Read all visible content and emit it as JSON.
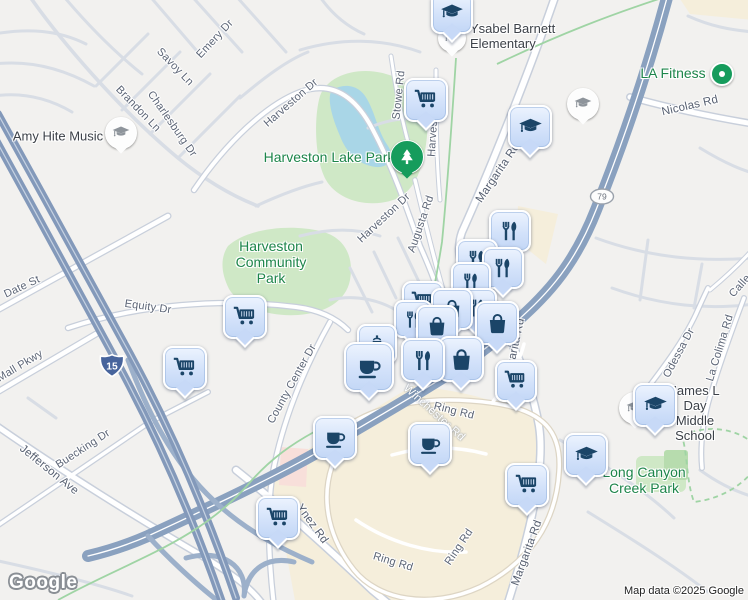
{
  "map": {
    "logo": "Google",
    "attribution": "Map data ©2025 Google",
    "colors": {
      "marker_fill": "#cfdffa",
      "marker_icon": "#1b4568",
      "gray_marker_icon": "#8e949b",
      "poi_green": "#1d854a",
      "street_label": "#5c6576",
      "freeway": "#8399ba",
      "park": "#cfe8c6",
      "water": "#a9d6e7",
      "commercial": "#f5eedb",
      "shield_interstate": "#47649c"
    },
    "shields": [
      {
        "id": "i-15",
        "system": "interstate",
        "label": "15",
        "x": 112,
        "y": 368
      },
      {
        "id": "ca-79",
        "system": "state",
        "label": "79",
        "x": 602,
        "y": 199
      }
    ],
    "street_labels": [
      {
        "id": "savoy-ln",
        "text": "Savoy Ln",
        "x": 175,
        "y": 67,
        "rot": 46
      },
      {
        "id": "emery-dr",
        "text": "Emery Dr",
        "x": 215,
        "y": 39,
        "rot": -47
      },
      {
        "id": "brandon-ln",
        "text": "Brandon Ln",
        "x": 138,
        "y": 109,
        "rot": 46
      },
      {
        "id": "charlesburg-dr",
        "text": "Charlesburg Dr",
        "x": 172,
        "y": 124,
        "rot": 55
      },
      {
        "id": "harveston-dr-1",
        "text": "Harveston Dr",
        "x": 291,
        "y": 103,
        "rot": -41
      },
      {
        "id": "stowe-rd",
        "text": "Stowe Rd",
        "x": 399,
        "y": 95,
        "rot": -84
      },
      {
        "id": "harveston-rd",
        "text": "Harveston Rd",
        "x": 434,
        "y": 122,
        "rot": -86
      },
      {
        "id": "nicolas-rd",
        "text": "Nicolas Rd",
        "x": 690,
        "y": 106,
        "rot": -13,
        "variant": "major"
      },
      {
        "id": "margarita-rd-1",
        "text": "Margarita Rd",
        "x": 498,
        "y": 173,
        "rot": -56,
        "variant": "major"
      },
      {
        "id": "harveston-dr-2",
        "text": "Harveston Dr",
        "x": 384,
        "y": 218,
        "rot": -43
      },
      {
        "id": "augusta-rd",
        "text": "Augusta Rd",
        "x": 421,
        "y": 224,
        "rot": -71
      },
      {
        "id": "date-st",
        "text": "Date St",
        "x": 22,
        "y": 287,
        "rot": -25
      },
      {
        "id": "equity-dr",
        "text": "Equity Dr",
        "x": 148,
        "y": 307,
        "rot": 8
      },
      {
        "id": "mall-pkwy",
        "text": "Mall Pkwy",
        "x": 20,
        "y": 366,
        "rot": -31
      },
      {
        "id": "county-center-dr",
        "text": "County Center Dr",
        "x": 292,
        "y": 384,
        "rot": -61
      },
      {
        "id": "winchester-rd",
        "text": "Winchester Rd",
        "x": 434,
        "y": 413,
        "rot": 42,
        "variant": "onroad major"
      },
      {
        "id": "ynez-rd",
        "text": "Ynez Rd",
        "x": 312,
        "y": 524,
        "rot": 54,
        "variant": "major"
      },
      {
        "id": "ring-rd-1",
        "text": "Ring Rd",
        "x": 454,
        "y": 411,
        "rot": 14
      },
      {
        "id": "ring-rd-2",
        "text": "Ring Rd",
        "x": 459,
        "y": 547,
        "rot": -56
      },
      {
        "id": "ring-rd-3",
        "text": "Ring Rd",
        "x": 393,
        "y": 562,
        "rot": 17
      },
      {
        "id": "jefferson-ave",
        "text": "Jefferson Ave",
        "x": 49,
        "y": 470,
        "rot": 39,
        "variant": "major"
      },
      {
        "id": "buecking-dr",
        "text": "Buecking Dr",
        "x": 83,
        "y": 449,
        "rot": -33
      },
      {
        "id": "margarita-rd-2",
        "text": "Margarita Rd",
        "x": 527,
        "y": 553,
        "rot": -70,
        "variant": "major"
      },
      {
        "id": "margarita-rd-3",
        "text": "Margarita Rd",
        "x": 514,
        "y": 352,
        "rot": -78,
        "variant": "major"
      },
      {
        "id": "odessa-dr",
        "text": "Odessa Dr",
        "x": 679,
        "y": 353,
        "rot": -62
      },
      {
        "id": "la-colima-rd",
        "text": "La Colima Rd",
        "x": 720,
        "y": 348,
        "rot": -73
      },
      {
        "id": "calle",
        "text": "Calle",
        "x": 740,
        "y": 286,
        "rot": -48
      }
    ],
    "poi_labels": [
      {
        "id": "ysabel-barnett-elementary",
        "lines": [
          "Ysabel Barnett",
          "Elementary"
        ],
        "x": 470,
        "y": 37,
        "color": "dark",
        "align": "left"
      },
      {
        "id": "amy-hite-music",
        "lines": [
          "Amy Hite Music"
        ],
        "x": 58,
        "y": 137,
        "color": "dark"
      },
      {
        "id": "la-fitness",
        "lines": [
          "LA Fitness"
        ],
        "x": 673,
        "y": 73,
        "color": "green",
        "size": "big"
      },
      {
        "id": "harveston-lake-park",
        "lines": [
          "Harveston Lake Park"
        ],
        "x": 329,
        "y": 157,
        "color": "green",
        "size": "big"
      },
      {
        "id": "harveston-community-park",
        "lines": [
          "Harveston",
          "Community",
          "Park"
        ],
        "x": 271,
        "y": 262,
        "color": "green",
        "size": "big"
      },
      {
        "id": "james-l-day-middle-school",
        "lines": [
          "James L Day",
          "Middle School"
        ],
        "x": 695,
        "y": 414,
        "color": "dark"
      },
      {
        "id": "long-canyon-creek-park",
        "lines": [
          "Long Canyon",
          "Creek Park"
        ],
        "x": 644,
        "y": 480,
        "color": "green",
        "size": "big"
      }
    ],
    "markers": [
      {
        "id": "school-pin-amy-hite",
        "icon": "grad",
        "variant": "gray",
        "x": 121,
        "y": 133,
        "size": 30
      },
      {
        "id": "school-pin-small-1",
        "icon": "grad",
        "variant": "gray",
        "x": 583,
        "y": 104,
        "size": 30
      },
      {
        "id": "school-pin-small-2",
        "icon": "grad",
        "variant": "gray",
        "x": 635,
        "y": 408,
        "size": 30
      },
      {
        "id": "school-pin-small-3",
        "icon": "grad",
        "variant": "gray",
        "x": 452,
        "y": 38,
        "size": 26,
        "z": 20
      },
      {
        "id": "park-pin-tree",
        "icon": "tree",
        "variant": "green-circle",
        "x": 407,
        "y": 157,
        "size": 32
      },
      {
        "id": "la-fitness-dot",
        "variant": "dot",
        "x": 722,
        "y": 74,
        "size": 20
      },
      {
        "id": "school-1",
        "icon": "grad",
        "x": 452,
        "y": 13,
        "size": 38,
        "z": 46
      },
      {
        "id": "grocery-1",
        "icon": "cart",
        "x": 426,
        "y": 100,
        "size": 40
      },
      {
        "id": "school-2",
        "icon": "grad",
        "x": 530,
        "y": 127,
        "size": 40
      },
      {
        "id": "restaurant-1",
        "icon": "fork",
        "x": 510,
        "y": 231,
        "size": 38
      },
      {
        "id": "restaurant-2",
        "icon": "fork",
        "x": 477,
        "y": 260,
        "size": 38
      },
      {
        "id": "restaurant-3",
        "icon": "fork",
        "x": 503,
        "y": 268,
        "size": 38
      },
      {
        "id": "restaurant-4",
        "icon": "fork",
        "x": 471,
        "y": 282,
        "size": 36
      },
      {
        "id": "grocery-2",
        "icon": "cart",
        "x": 423,
        "y": 302,
        "size": 38
      },
      {
        "id": "restaurant-5",
        "icon": "fork",
        "x": 477,
        "y": 308,
        "size": 36
      },
      {
        "id": "shopping-1",
        "icon": "bag",
        "x": 452,
        "y": 309,
        "size": 38
      },
      {
        "id": "grocery-3",
        "icon": "cart",
        "x": 245,
        "y": 317,
        "size": 40
      },
      {
        "id": "restaurant-6",
        "icon": "fork",
        "x": 413,
        "y": 319,
        "size": 34
      },
      {
        "id": "shopping-2",
        "icon": "bag",
        "x": 497,
        "y": 323,
        "size": 40
      },
      {
        "id": "shopping-3",
        "icon": "bag",
        "x": 437,
        "y": 326,
        "size": 38
      },
      {
        "id": "cafe-kettle",
        "icon": "kettle",
        "x": 377,
        "y": 344,
        "size": 36
      },
      {
        "id": "shopping-4",
        "icon": "bag",
        "x": 461,
        "y": 359,
        "size": 42
      },
      {
        "id": "restaurant-7",
        "icon": "fork",
        "x": 423,
        "y": 360,
        "size": 40
      },
      {
        "id": "cafe-1",
        "icon": "cup",
        "x": 369,
        "y": 367,
        "size": 46
      },
      {
        "id": "grocery-4",
        "icon": "cart",
        "x": 185,
        "y": 368,
        "size": 40
      },
      {
        "id": "grocery-5",
        "icon": "cart",
        "x": 516,
        "y": 381,
        "size": 38
      },
      {
        "id": "school-3",
        "icon": "grad",
        "x": 655,
        "y": 405,
        "size": 40
      },
      {
        "id": "cafe-2",
        "icon": "cup",
        "x": 335,
        "y": 438,
        "size": 40
      },
      {
        "id": "cafe-3",
        "icon": "cup",
        "x": 430,
        "y": 444,
        "size": 40
      },
      {
        "id": "school-4",
        "icon": "grad",
        "x": 586,
        "y": 455,
        "size": 40
      },
      {
        "id": "grocery-6",
        "icon": "cart",
        "x": 527,
        "y": 485,
        "size": 40
      },
      {
        "id": "grocery-7",
        "icon": "cart",
        "x": 278,
        "y": 518,
        "size": 40
      }
    ]
  }
}
